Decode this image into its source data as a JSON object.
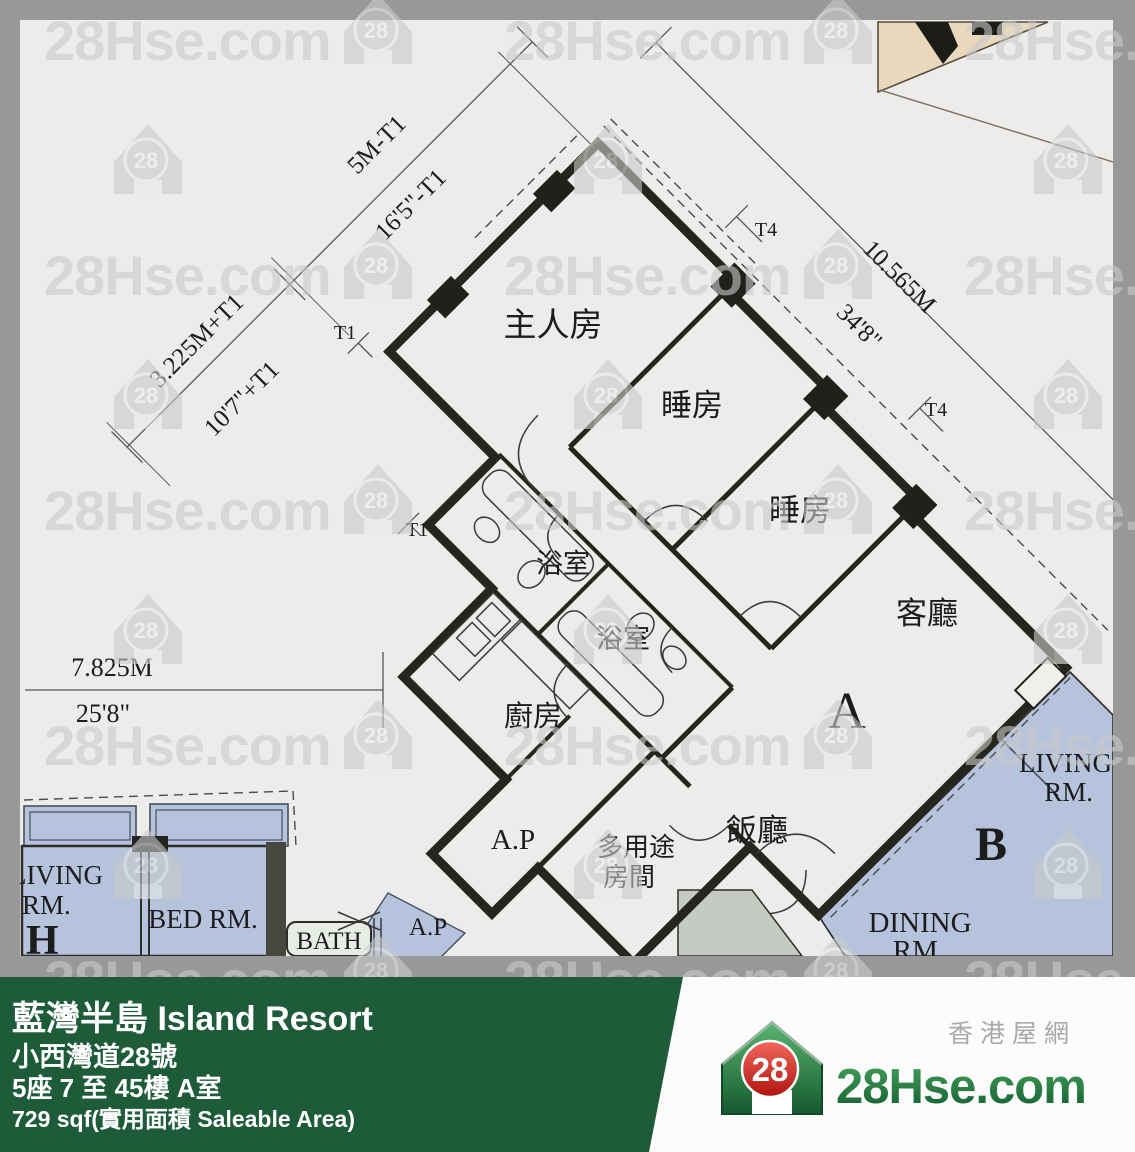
{
  "page": {
    "width": 1135,
    "height": 1152
  },
  "floor_plan": {
    "unit_label": "A",
    "rooms": {
      "master": "主人房",
      "bedroom1": "睡房",
      "bedroom2": "睡房",
      "living": "客廳",
      "dining": "飯廳",
      "bath1": "浴室",
      "bath2": "浴室",
      "kitchen": "廚房",
      "multi1": "多用途",
      "multi2": "房間",
      "ap": "A.P"
    },
    "dims": {
      "nw_m": "5M-T1",
      "nw_ft": "16'5\"-T1",
      "w_m": "3.225M+T1",
      "w_ft": "10'7\"+T1",
      "ne_m": "10.565M",
      "ne_ft": "34'8\"",
      "sw_m": "7.825M",
      "sw_ft": "25'8\"",
      "t1": "T1",
      "t4": "T4"
    },
    "unit_b": {
      "label": "B",
      "living1": "LIVING",
      "living2": "RM.",
      "dining1": "DINING",
      "dining2": "RM."
    },
    "unit_h": {
      "label": "H",
      "living1": "LIVING",
      "living2": "RM.",
      "bed": "BED RM.",
      "bath": "BATH",
      "ap": "A.P"
    }
  },
  "watermark": {
    "text": "28Hse.com",
    "badge": "28"
  },
  "footer": {
    "title": "藍灣半島 Island Resort",
    "address": "小西灣道28號",
    "block_floor": "5座 7 至 45樓 A室",
    "area": "729 sqf(實用面積 Saleable Area)"
  },
  "brand": {
    "site": "28Hse.com",
    "site_cn": "香港屋網",
    "logo_number": "28"
  },
  "colors": {
    "footer_green": "#1d5b39",
    "logo_green": "#1e7a3c",
    "logo_red": "#d7261d",
    "plan_green": "#b4cec1",
    "neighbor_blue": "#b5c3dc",
    "wedge_beige": "#ead8bd",
    "frame_gray": "#989898"
  }
}
